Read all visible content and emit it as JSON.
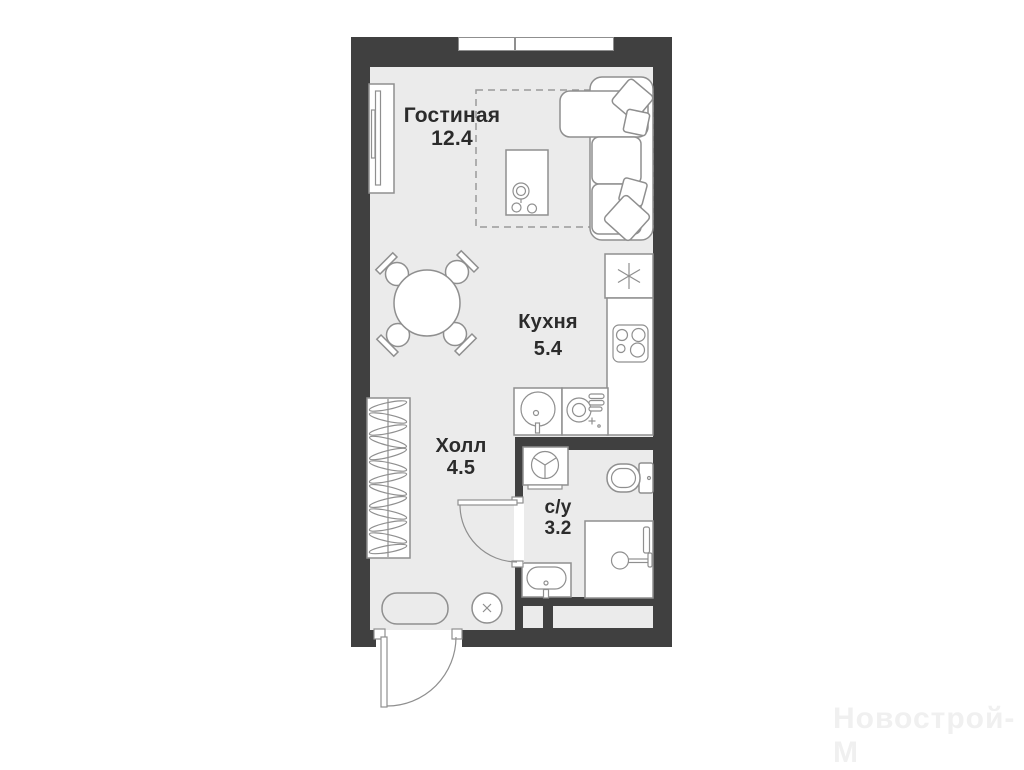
{
  "plan": {
    "title": "studio-apartment-floor-plan",
    "rooms": [
      {
        "id": "living",
        "label": "Гостиная",
        "area": "12.4"
      },
      {
        "id": "kitchen",
        "label": "Кухня",
        "area": "5.4"
      },
      {
        "id": "hall",
        "label": "Холл",
        "area": "4.5"
      },
      {
        "id": "bathroom",
        "label": "с/у",
        "area": "3.2"
      }
    ],
    "watermark": "Новострой-М",
    "furniture": [
      "tv-unit",
      "sofa",
      "pillows",
      "side-table",
      "dining-table",
      "chairs",
      "fridge",
      "hob",
      "kitchen-sink",
      "dishwasher",
      "washing-machine",
      "toilet",
      "shower",
      "bathroom-sink",
      "wardrobe",
      "rug",
      "stool",
      "entry-door",
      "bathroom-door",
      "window"
    ],
    "colors": {
      "wall": "#404040",
      "floor": "#ebebeb",
      "outline": "#8f8f8f",
      "ink": "#2b2b2b",
      "paper": "#ffffff",
      "dash": "#9a9a9a",
      "wm": "#f0f0f0"
    }
  }
}
